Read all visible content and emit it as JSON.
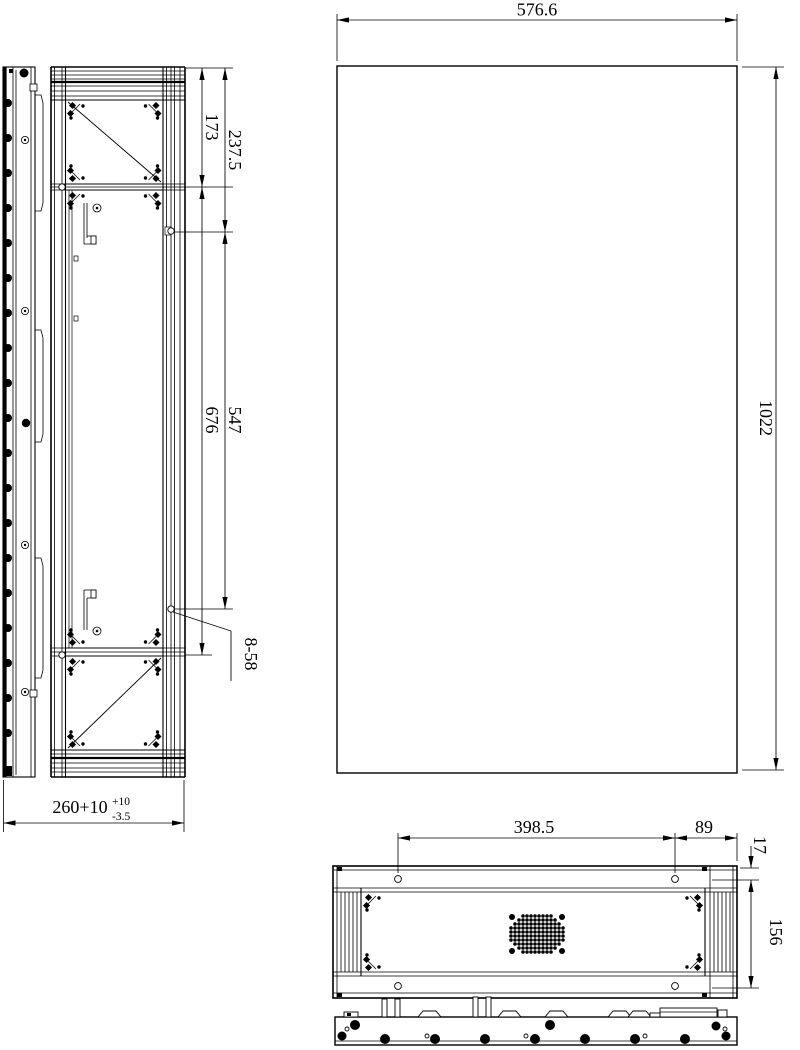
{
  "dimensions": {
    "front_width": "576.6",
    "front_height": "1022",
    "side_hole_offset_a": "173",
    "side_hole_offset_b": "237.5",
    "side_hole_span_a": "676",
    "side_hole_span_b": "547",
    "hole_callout": "8-58",
    "depth": "260+10",
    "depth_tol_plus": "+10",
    "depth_tol_minus": "-3.5",
    "rear_hole_span": "398.5",
    "rear_hole_edge": "89",
    "rear_hole_offset": "17",
    "rear_hole_row_span": "156"
  },
  "colors": {
    "line": "#000000",
    "background": "#ffffff"
  }
}
